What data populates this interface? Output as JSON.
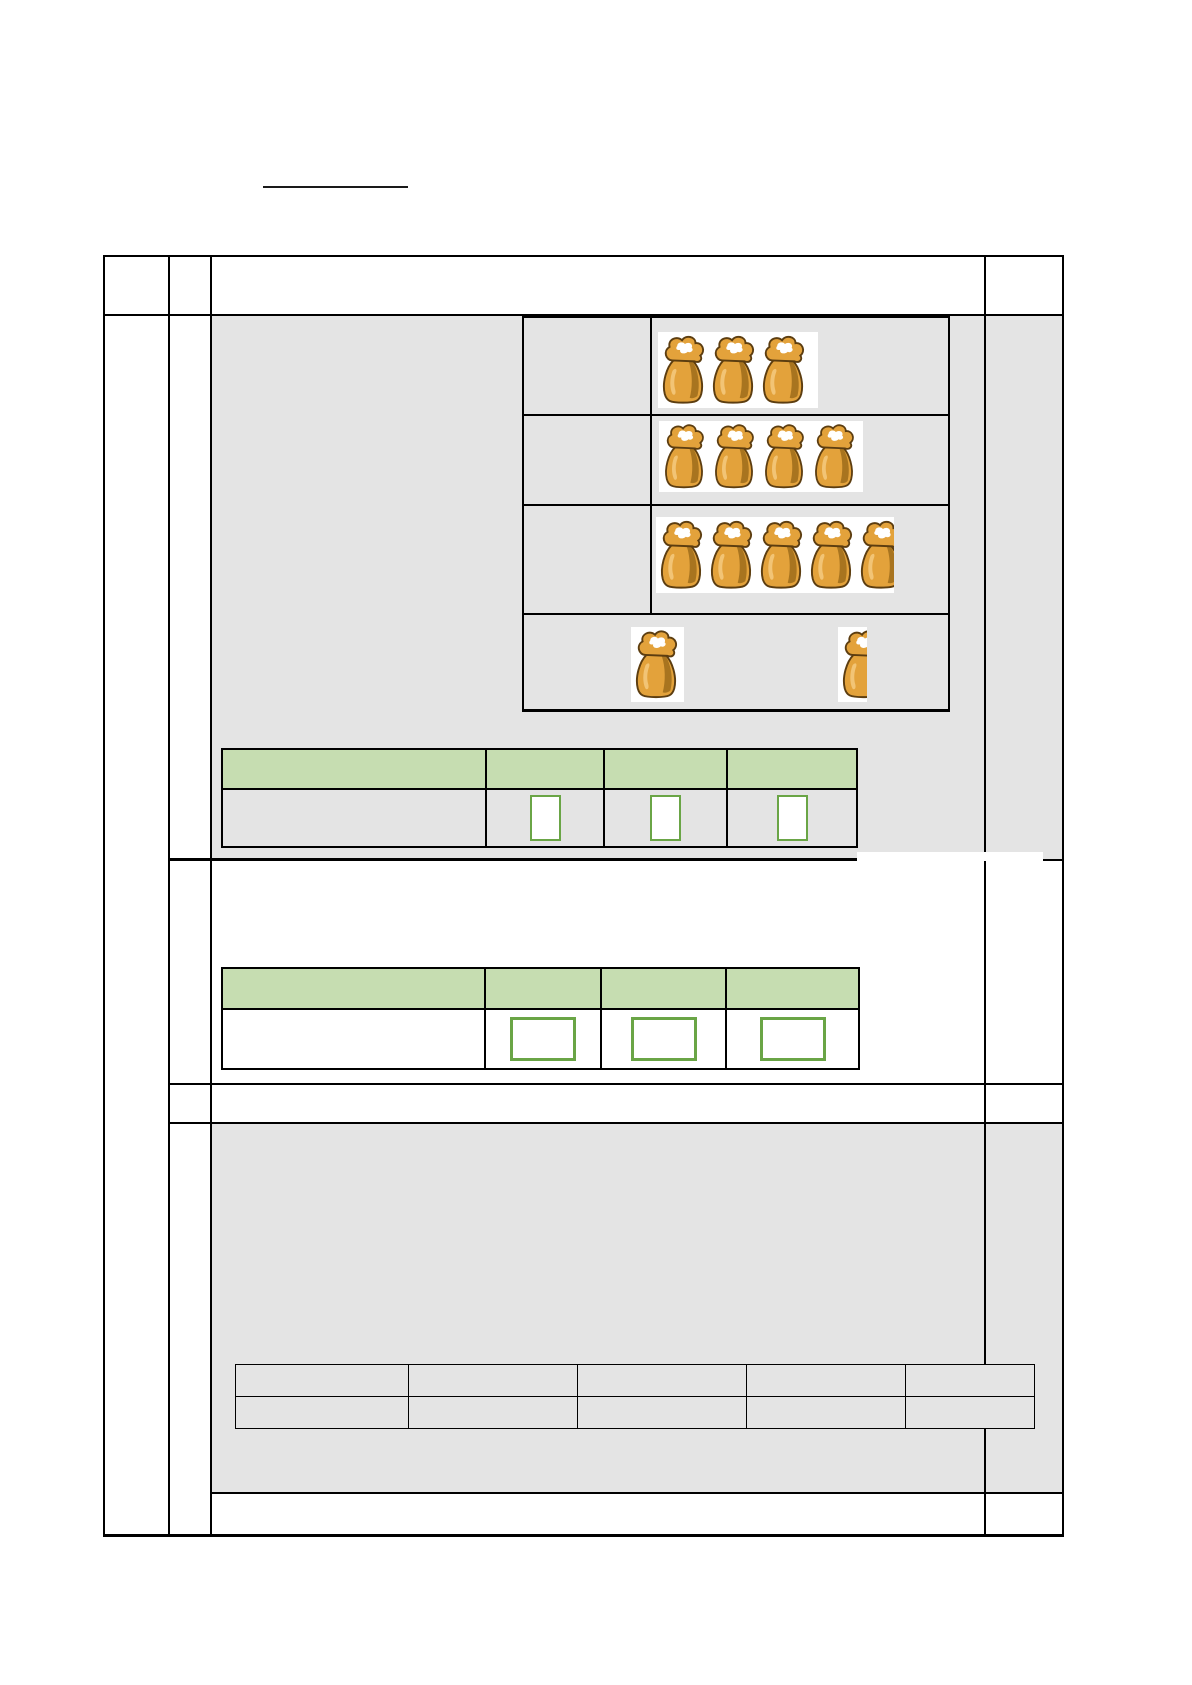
{
  "document": {
    "type": "worksheet-grid-page",
    "title_blank": "",
    "colors": {
      "page_bg": "#ffffff",
      "section_gray": "#e4e4e4",
      "grid_border": "#000000",
      "green_header_fill": "#c6ddb1",
      "answer_box_border": "#6aa546",
      "answer_box_fill": "#ffffff",
      "sack_body": "#e3a23b",
      "sack_outline": "#5c3d10",
      "sack_highlight": "#f2c475",
      "sack_fold": "#a8741f",
      "sack_flour": "#ffffff"
    },
    "bag_table": {
      "rows": [
        {
          "blocks": [
            {
              "bags": 3
            }
          ]
        },
        {
          "blocks": [
            {
              "bags": 4
            }
          ]
        },
        {
          "blocks": [
            {
              "bags": 5,
              "last_partial": true
            }
          ]
        },
        {
          "blocks": [
            {
              "bags": 1
            },
            {
              "bags": 1,
              "partial": true
            }
          ]
        }
      ]
    },
    "answer_table_1": {
      "header_cells": [
        "",
        "",
        "",
        ""
      ],
      "boxes": [
        "",
        "",
        ""
      ]
    },
    "answer_table_2": {
      "header_cells": [
        "",
        "",
        "",
        ""
      ],
      "boxes": [
        "",
        "",
        ""
      ]
    },
    "answer_line_value": "",
    "bottom_table": {
      "columns": 5,
      "rows": [
        [
          "",
          "",
          "",
          "",
          ""
        ],
        [
          "",
          "",
          "",
          "",
          ""
        ]
      ]
    }
  }
}
